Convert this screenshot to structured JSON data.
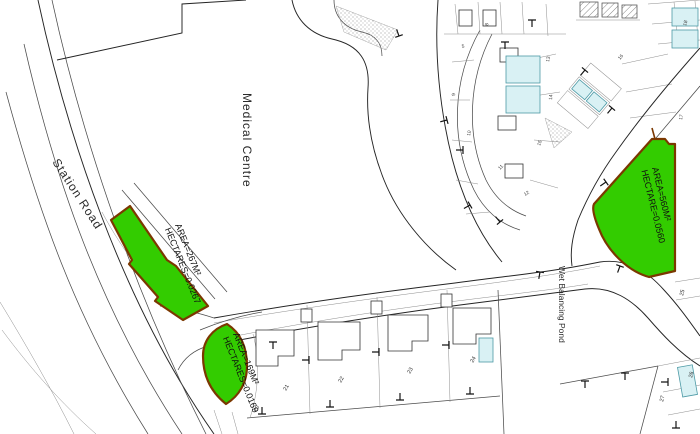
{
  "drawing": {
    "labels": {
      "station_road": "Station Road",
      "medical_centre": "Medical Centre",
      "wet_balancing_pond": "Wet Balancing Pond"
    },
    "highlighted_areas": [
      {
        "area": "AREA=267M²",
        "hectares": "HECTARES=0.0267"
      },
      {
        "area": "AREA=169M²",
        "hectares": "HECTARES=0.0169"
      },
      {
        "area": "AREA=560M²",
        "hectares": "HECTARE=0.0560"
      }
    ],
    "plot_numbers": [
      "20",
      "21",
      "22",
      "23",
      "24",
      "25",
      "26",
      "27"
    ],
    "parcel_numbers": [
      "5",
      "8",
      "9",
      "10",
      "11",
      "12",
      "13",
      "14",
      "15",
      "16",
      "17",
      "18"
    ],
    "colors": {
      "highlight_fill": "#33cc00",
      "highlight_border": "#7b3800",
      "tinted_parcel_fill": "#d9f1f4",
      "tinted_parcel_border": "#4d9aa6",
      "linework": "#4b4b4b",
      "background": "#ffffff"
    }
  }
}
